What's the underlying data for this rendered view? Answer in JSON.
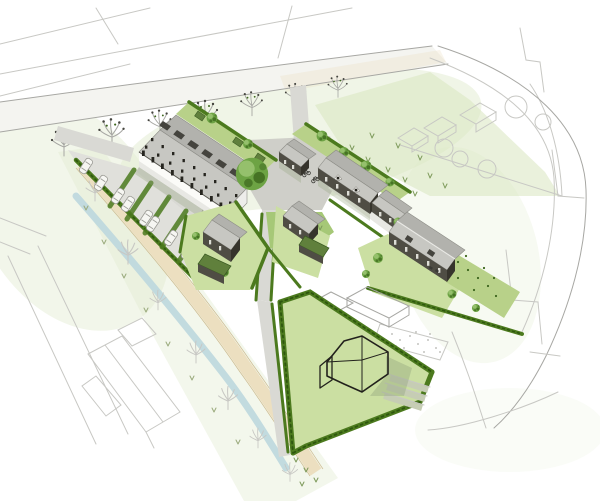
{
  "meta": {
    "title": "Aerial masterplan sketch",
    "description": "Hand drawn aerial illustration of a small housing development: a terraced row with a solar panelled roof and hedged parking court, gabled courtyard houses around a planted plaza with a large tree and bicycles, a dark timber semi detached pair in hedged gardens, a retained white farmhouse on a large hedged lawn, a tree lined main road above, a stream side footpath crossing the site, and faint pencil sketched context of roads, fields and neighbouring houses",
    "medium": "watercolour and ink style architectural sketch without text labels"
  },
  "colors": {
    "paper": "#ffffff",
    "wash": "#e2ecd0",
    "wash2": "#d9e6bf",
    "lawn": "#cbdfa2",
    "lawn2": "#b8d189",
    "green": "#a6c877",
    "hedge": "#4c7a1e",
    "hedgeDark": "#2e570e",
    "tree": "#6da344",
    "treeLight": "#9cc573",
    "treeDark": "#3c661d",
    "roof": "#c7c7c2",
    "roofDark": "#b2b2ad",
    "panel": "#45443e",
    "wallDark": "#4f4d44",
    "wallDarker": "#36342c",
    "shade": "#e0e0db",
    "window": "#26251f",
    "road": "#d9d9d4",
    "plaza": "#cfcfc9",
    "pathBeige": "#ecdfc0",
    "stream": "#bdd7de",
    "sketch": "#a7a7a3",
    "sketchLight": "#c8c8c4",
    "ink": "#22211c",
    "shadow": "#91a27c",
    "car": "#f6f6f2",
    "gravel": "#f1eee3",
    "shedRoof": "#60803c"
  },
  "inventory": {
    "street_trees": 7,
    "corridor_trees": 7,
    "parked_cars": 11,
    "bike_symbols": 3,
    "buildings": [
      {
        "id": "terraced-block",
        "description": "long terraced row with white walls and grey roof with solar panels"
      },
      {
        "id": "plaza-house-small",
        "description": "small gabled house beside the plaza"
      },
      {
        "id": "plaza-house-large",
        "description": "large gabled house with two dormers"
      },
      {
        "id": "plaza-house-extension",
        "description": "lower gabled wing"
      },
      {
        "id": "semi-detached-pair",
        "description": "dark walled pair with rooflights in a hedged garden"
      },
      {
        "id": "detached-house-west",
        "description": "dark house with a green flat roofed wing"
      },
      {
        "id": "detached-house-middle",
        "description": "dark house with a green flat roofed wing"
      },
      {
        "id": "white-farmhouse",
        "description": "retained white farmhouse on a hedged lawn"
      },
      {
        "id": "sketched-context-buildings",
        "description": "outline only neighbouring houses and barns"
      }
    ]
  }
}
